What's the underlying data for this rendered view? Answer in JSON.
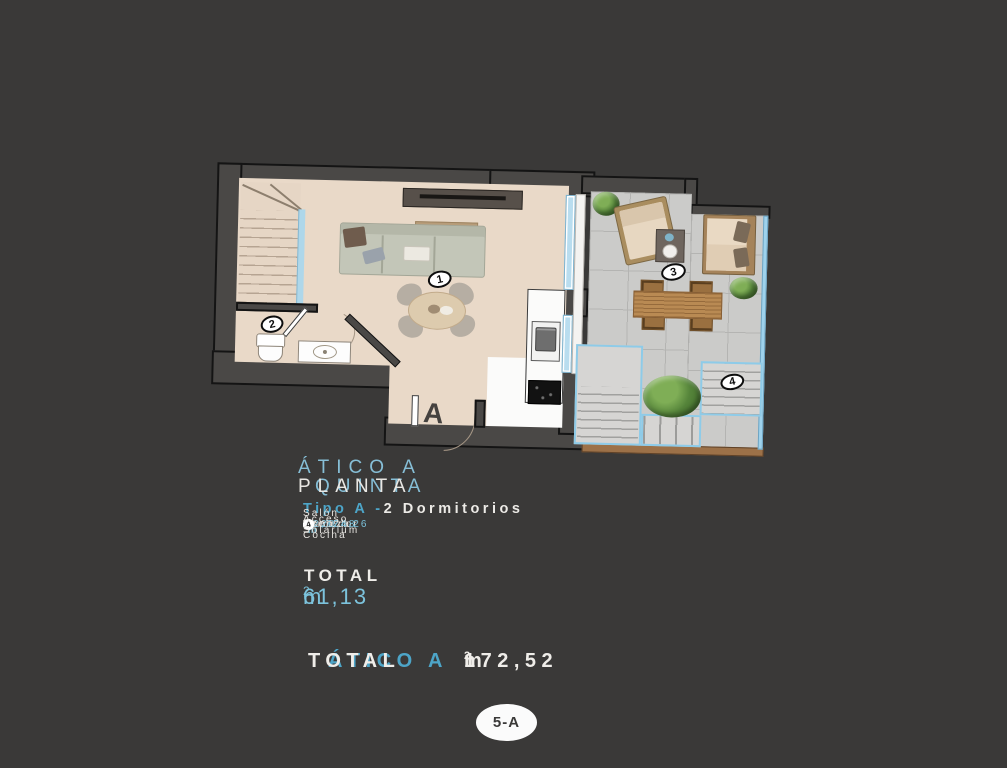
{
  "colors": {
    "bg": "#3a3938",
    "accent": "#7cc3dc",
    "accentstrong": "#4da5c8",
    "titleblue": "#86bed6"
  },
  "plan": {
    "door_label": "A",
    "markers": [
      "1",
      "2",
      "3",
      "4"
    ]
  },
  "info": {
    "title": "ÁTICO A",
    "subtitle_left": "PLANTA",
    "subtitle_right": "QUINTA",
    "type_prefix": "Tipo A -",
    "type_suffix": "2 Dormitorios",
    "legend": [
      {
        "num": "1",
        "label": "Salón Comedor Cocina",
        "value": "24,26",
        "unit": "m",
        "sup": "2"
      },
      {
        "num": "2",
        "label": "Aseo",
        "value": "2,77",
        "unit": "m",
        "sup": "2"
      },
      {
        "num": "3",
        "label": "Terraza",
        "value": "20,48",
        "unit": "m",
        "sup": "2"
      },
      {
        "num": "4",
        "label": "Acceso Solárium",
        "value": "",
        "unit": "",
        "sup": ""
      }
    ],
    "total_label": "TOTAL",
    "total_value": "61,13",
    "total_unit": "m",
    "total_sup": "2"
  },
  "grand_total": {
    "prefix": "TOTAL",
    "name": "ÁTICO A",
    "value": "172,52",
    "unit": "m",
    "sup": "2"
  },
  "badge": "5-A"
}
